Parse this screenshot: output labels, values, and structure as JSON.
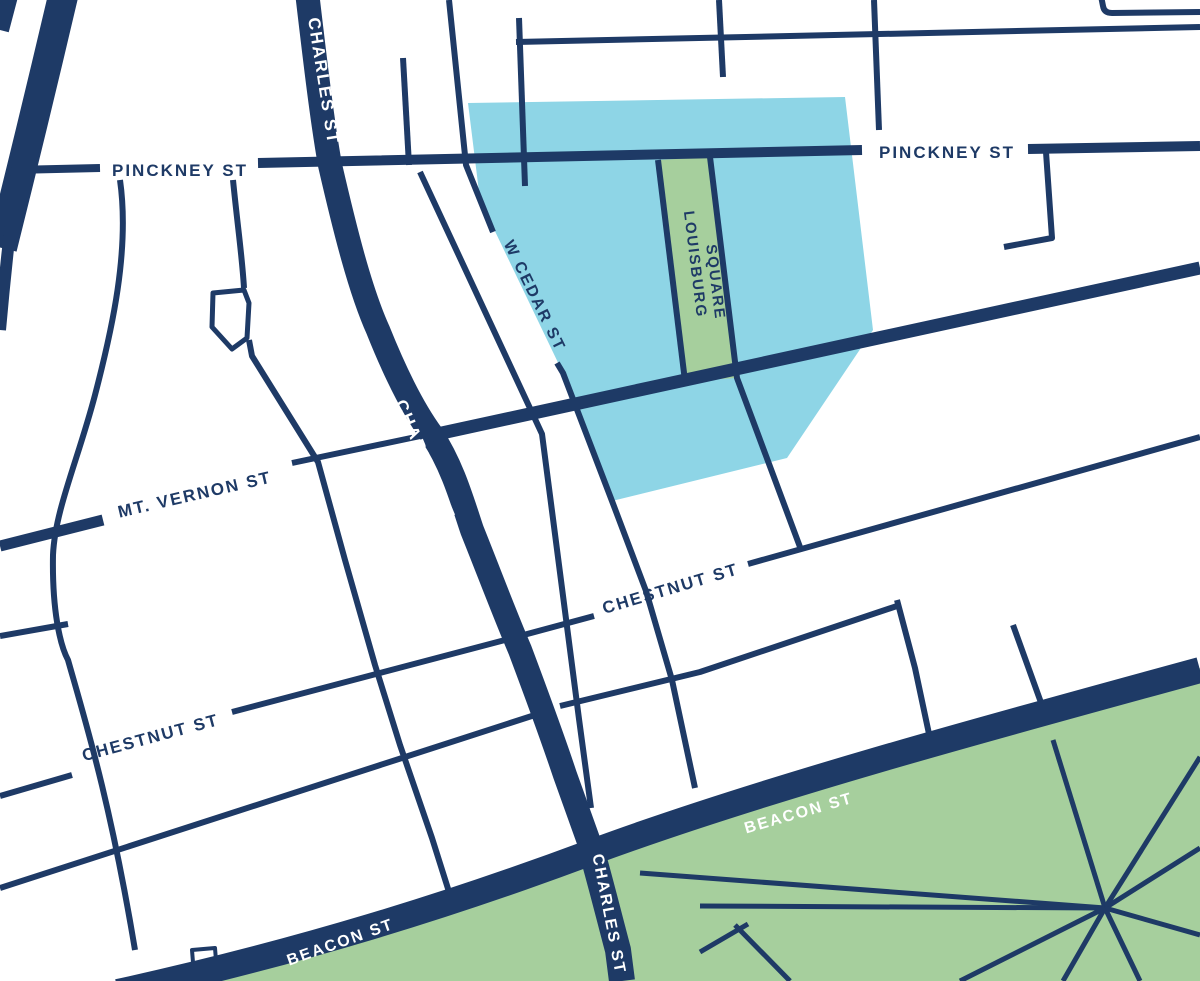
{
  "colors": {
    "navy": "#1e3a66",
    "highlight_blue": "#8ed5e6",
    "park_green": "#a6cf9d",
    "square_green": "#a6cf9d",
    "background": "#ffffff",
    "label_on_road": "#ffffff"
  },
  "labels": {
    "pinckney_west": "PINCKNEY ST",
    "pinckney_east": "PINCKNEY ST",
    "charles_north": "CHARLES ST",
    "charles_mid": "CHARLES ST",
    "charles_south": "CHARLES ST",
    "w_cedar": "W CEDAR ST",
    "louisburg_line1": "LOUISBURG",
    "louisburg_line2": "SQUARE",
    "mt_vernon": "MT. VERNON ST",
    "chestnut_east": "CHESTNUT ST",
    "chestnut_west": "CHESTNUT ST",
    "beacon_east": "BEACON ST",
    "beacon_west": "BEACON ST"
  }
}
